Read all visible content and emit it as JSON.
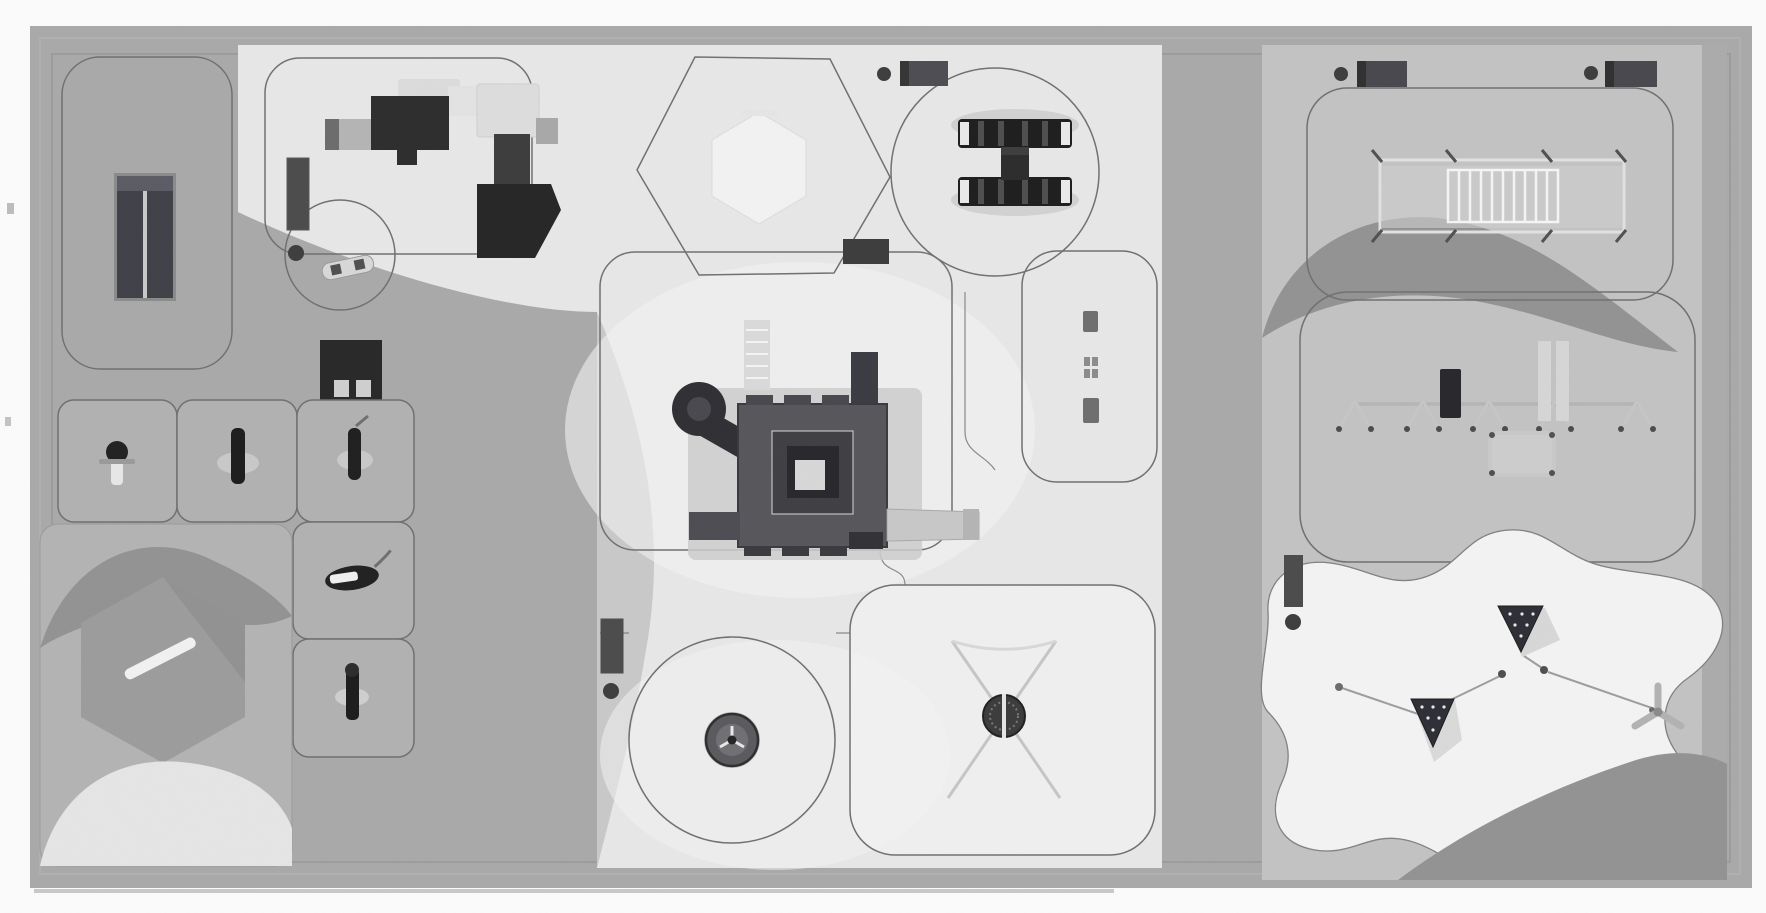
{
  "document": {
    "kind": "playground-site-plan",
    "view": "top-down architectural rendering (scanned grayscale print)",
    "text_labels": [],
    "sections_count": 3
  },
  "palette": {
    "page_bg": "#fcfcfc",
    "pavement": "#a9a9a9",
    "frame_line": "#959595",
    "surface": "#e8e8e8",
    "surface_bright": "#f3f3f3",
    "surface_shade": "#c9c9c9",
    "right_bg": "#c3c3c3",
    "zone_fill": "#b1b1b1",
    "organic_bg": "#b3b3b3",
    "swoosh_dark": "#929292",
    "hex_sand": "#9c9c9c",
    "outline": "#6f6f6f",
    "equip_dark": "#262626",
    "equip_mid": "#55555a",
    "equip_gray": "#6e6e6e",
    "equip_light": "#d6d6d6",
    "bench_color": "#4a4a4a",
    "bin_color": "#3c3c3c",
    "rope": "#9d9d9d",
    "white_blob": "#f4f4f4"
  },
  "sections": [
    {
      "id": "west-area",
      "zones": [
        {
          "id": "table-zone",
          "equipment": [
            "double-table (table-tennis style)"
          ]
        },
        {
          "id": "game-table",
          "equipment": [
            "game table with two seats",
            "bench"
          ]
        },
        {
          "id": "spring-rider-grid",
          "equipment": [
            "spring rider 1",
            "spring rider 2",
            "spring rider 3",
            "spring rider 4",
            "spring rider 5"
          ]
        },
        {
          "id": "sand-garden",
          "equipment": [
            "hexagonal sand area",
            "white bench bar",
            "terrain waves"
          ]
        }
      ]
    },
    {
      "id": "central-area",
      "zones": [
        {
          "id": "toddler-corner",
          "equipment": [
            "playhouse with slide A",
            "playhouse with slide B",
            "spring seesaw",
            "bench",
            "litter bin"
          ]
        },
        {
          "id": "hexagon-canopy-zone",
          "equipment": [
            "hexagonal canopy / sand table"
          ]
        },
        {
          "id": "seesaw-circle",
          "equipment": [
            "multi-seat seesaw (H-shape)",
            "bench top",
            "bench bottom",
            "litter bin"
          ]
        },
        {
          "id": "balance-trail-zone",
          "equipment": [
            "balance trail elements x3"
          ]
        },
        {
          "id": "main-structure-zone",
          "equipment": [
            "large play tower with nested platforms",
            "tube slide",
            "climbing ladder",
            "straight slide",
            "climb block"
          ]
        },
        {
          "id": "spinner-circle",
          "equipment": [
            "carousel spinner",
            "bench",
            "litter bin"
          ]
        },
        {
          "id": "basket-swing-zone",
          "equipment": [
            "nest basket swing on X-frame"
          ]
        }
      ]
    },
    {
      "id": "east-area",
      "zones": [
        {
          "id": "monkey-bar-zone",
          "equipment": [
            "horizontal ladder / climbing frame",
            "bench x2",
            "litter bin x2"
          ]
        },
        {
          "id": "swing-zone",
          "equipment": [
            "multi-bay swing set",
            "dark support pole",
            "twin tall posts",
            "nest seat"
          ]
        },
        {
          "id": "rope-play-zone",
          "equipment": [
            "rope pyramid net 1",
            "rope pyramid net 2",
            "three-arm rotor",
            "connecting ropes",
            "bench",
            "litter bin"
          ]
        }
      ]
    }
  ],
  "counts": {
    "benches": 7,
    "litter_bins": 6,
    "spring_riders": 6,
    "slides": 3,
    "circular_safety_zones": 4
  }
}
